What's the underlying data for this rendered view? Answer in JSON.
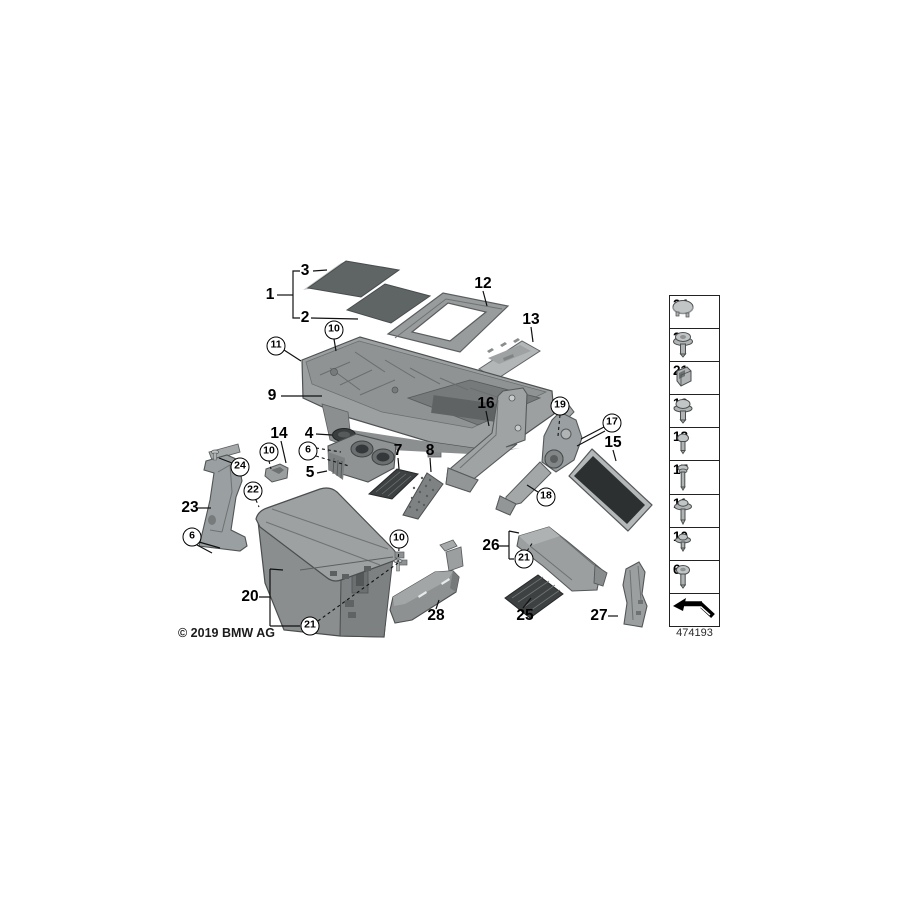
{
  "diagram": {
    "copyright": "© 2019 BMW AG",
    "diagram_number": "474193"
  },
  "callouts": {
    "n1": "1",
    "n2": "2",
    "n3": "3",
    "n4": "4",
    "n5": "5",
    "n6": "6",
    "n7": "7",
    "n8": "8",
    "n9": "9",
    "n10": "10",
    "n11": "11",
    "n12": "12",
    "n13": "13",
    "n14": "14",
    "n15": "15",
    "n16": "16",
    "n17": "17",
    "n18": "18",
    "n19": "19",
    "n20": "20",
    "n21": "21",
    "n22": "22",
    "n23": "23",
    "n24": "24",
    "n25": "25",
    "n26": "26",
    "n27": "27",
    "n28": "28"
  },
  "sidebar": {
    "items": [
      {
        "label": "24",
        "icon": "cap-plug-icon"
      },
      {
        "label": "22",
        "icon": "screw-with-washer-icon"
      },
      {
        "label": "21",
        "icon": "clip-icon"
      },
      {
        "label": "19",
        "icon": "screw-with-washer-icon"
      },
      {
        "label": "18",
        "icon": "small-screw-icon"
      },
      {
        "label": "17",
        "icon": "long-screw-icon"
      },
      {
        "label": "11",
        "icon": "long-screw-with-washer-icon"
      },
      {
        "label": "10",
        "icon": "short-screw-with-washer-icon"
      },
      {
        "label": "6",
        "icon": "round-head-screw-icon"
      }
    ],
    "footer_icon": "exploded-view-arrow-icon"
  }
}
